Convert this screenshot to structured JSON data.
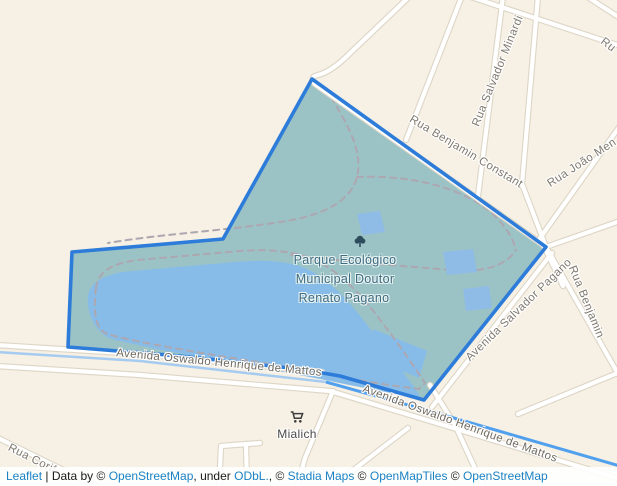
{
  "map": {
    "park_label": {
      "line1": "Parque Ecológico",
      "line2": "Municipal Doutor",
      "line3": "Renato Pagano"
    },
    "streets": {
      "rua_benjamin_constant": "Rua Benjamin Constant",
      "rua_salvador_minardi": "Rua Salvador Minardi",
      "rua_joao": "Rua João Men",
      "rua_top_right_partial": "Ru",
      "rua_benjamin_right": "Rua Benjamin",
      "avenida_salvador_pagano": "Avenida Salvador Pagano",
      "avenida_oswaldo_west": "Avenida Oswaldo Henrique de Mattos",
      "avenida_oswaldo_east": "Avenida Oswaldo Henrique de Mattos",
      "rua_corif": "Rua Corif"
    },
    "poi": {
      "mialich": "Mialich"
    },
    "icons": {
      "tree": "tree-icon",
      "cart": "shopping-cart-icon"
    },
    "colors": {
      "background": "#f6f0e5",
      "park_fill": "#9bc3c6",
      "lake": "#87bce9",
      "building": "#8fbce7",
      "polygon_stroke": "#2d7cd9",
      "road": "#ffffff",
      "road_casing": "#ddd6c6",
      "trail_dash": "#aca7b0",
      "stream_light": "#a6cbf0",
      "stream_bright": "#51a0ee",
      "street_label": "#7e786e",
      "park_label": "#3f6b82",
      "attribution_link": "#1b82c4"
    }
  },
  "attribution": {
    "leaflet": "Leaflet",
    "sep": " | Data by © ",
    "osm1": "OpenStreetMap",
    "under": ", under ",
    "odbl": "ODbL.",
    "comma1": ", © ",
    "stadia": "Stadia Maps",
    "c2": " © ",
    "openmaptiles": "OpenMapTiles",
    "c3": " © ",
    "osm2": "OpenStreetMap",
    "contributors": " contributors"
  }
}
